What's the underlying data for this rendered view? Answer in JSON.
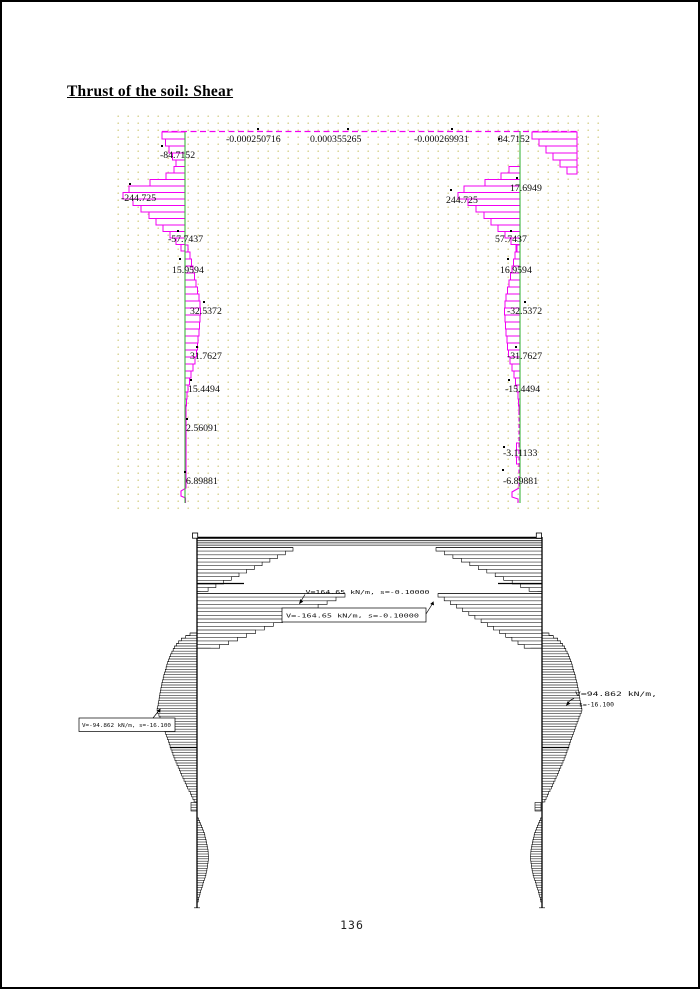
{
  "page": {
    "title": "Thrust of the soil: Shear",
    "page_number": "136"
  },
  "colors": {
    "shear_envelope_magenta": "#f200f2",
    "wall_reference_green": "#3cb43c",
    "grid_dot": "#d9d392",
    "ink": "#000000",
    "paper": "#ffffff"
  },
  "chart_data": [
    {
      "type": "line",
      "subtype": "frame shear-force diagram: magenta stepped envelope on green wall reference lines over a dotted grid",
      "title": "Thrust of the soil: Shear",
      "legend": "none",
      "grid": "dotted",
      "series": [
        {
          "name": "top-member",
          "values": [
            "-0.000250716",
            "0.000355265",
            "-0.000269931",
            "84.7152"
          ]
        },
        {
          "name": "left-wall",
          "values": [
            "-84.7152",
            "-244.725",
            "-57.7437",
            "15.9594",
            "32.5372",
            "31.7627",
            "15.4494",
            "2.56091",
            "6.89881"
          ]
        },
        {
          "name": "right-wall",
          "values": [
            "17.6949",
            "244.725",
            "57.7437",
            "16.9594",
            "-32.5372",
            "-31.7627",
            "-15.4494",
            "-3.11133",
            "-6.89881"
          ]
        }
      ]
    },
    {
      "type": "line",
      "subtype": "frame shear-force diagram: black horizontal hatching with peak-value callouts",
      "annotations": [
        {
          "position": "top-member-left-peak",
          "text": "V=164.65 kN/m, s=-0.10000",
          "boxed": false
        },
        {
          "position": "top-member-right-peak",
          "text": "V=-164.65 kN/m, s=-0.10000",
          "boxed": true
        },
        {
          "position": "left-wall-peak",
          "text": "V=-94.862 kN/m, s=-16.100",
          "boxed": true
        },
        {
          "position": "right-wall-peak",
          "text": "V=94.862 kN/m,",
          "text2": "s=-16.100",
          "boxed": false
        }
      ]
    }
  ]
}
